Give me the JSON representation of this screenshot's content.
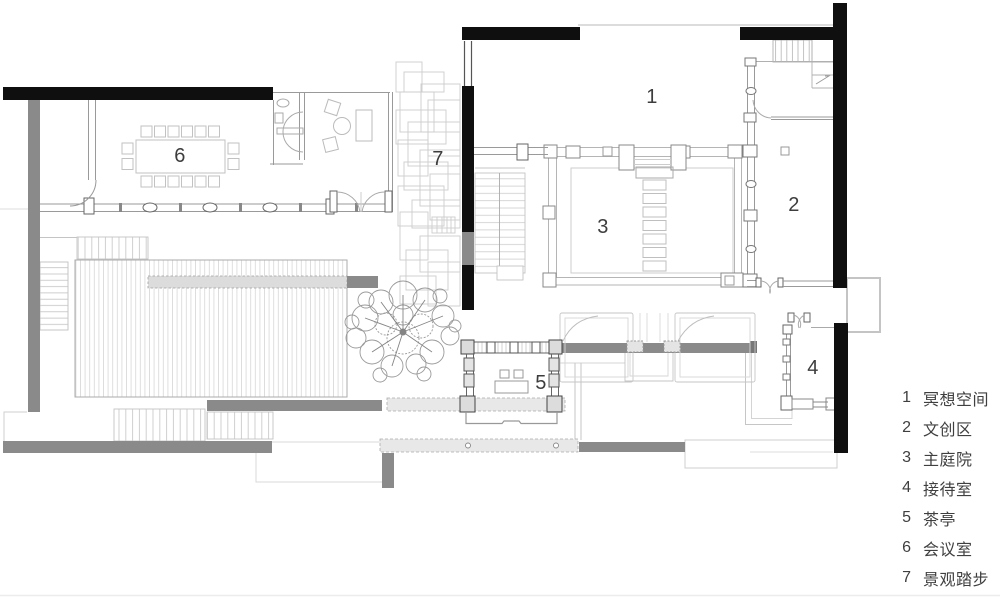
{
  "plan": {
    "rooms": [
      {
        "number": "1",
        "name": "冥想空间"
      },
      {
        "number": "2",
        "name": "文创区"
      },
      {
        "number": "3",
        "name": "主庭院"
      },
      {
        "number": "4",
        "name": "接待室"
      },
      {
        "number": "5",
        "name": "茶亭"
      },
      {
        "number": "6",
        "name": "会议室"
      },
      {
        "number": "7",
        "name": "景观踏步"
      }
    ]
  },
  "legend": {
    "items": [
      {
        "number": "1",
        "label": "冥想空间"
      },
      {
        "number": "2",
        "label": "文创区"
      },
      {
        "number": "3",
        "label": "主庭院"
      },
      {
        "number": "4",
        "label": "接待室"
      },
      {
        "number": "5",
        "label": "茶亭"
      },
      {
        "number": "6",
        "label": "会议室"
      },
      {
        "number": "7",
        "label": "景观踏步"
      }
    ]
  },
  "colors": {
    "wall_black": "#0f0f0f",
    "wall_gray": "#8a8a8a",
    "paving_light": "#e6e6e6",
    "line_light": "#c6c6c6",
    "text": "#3f3f3f"
  }
}
